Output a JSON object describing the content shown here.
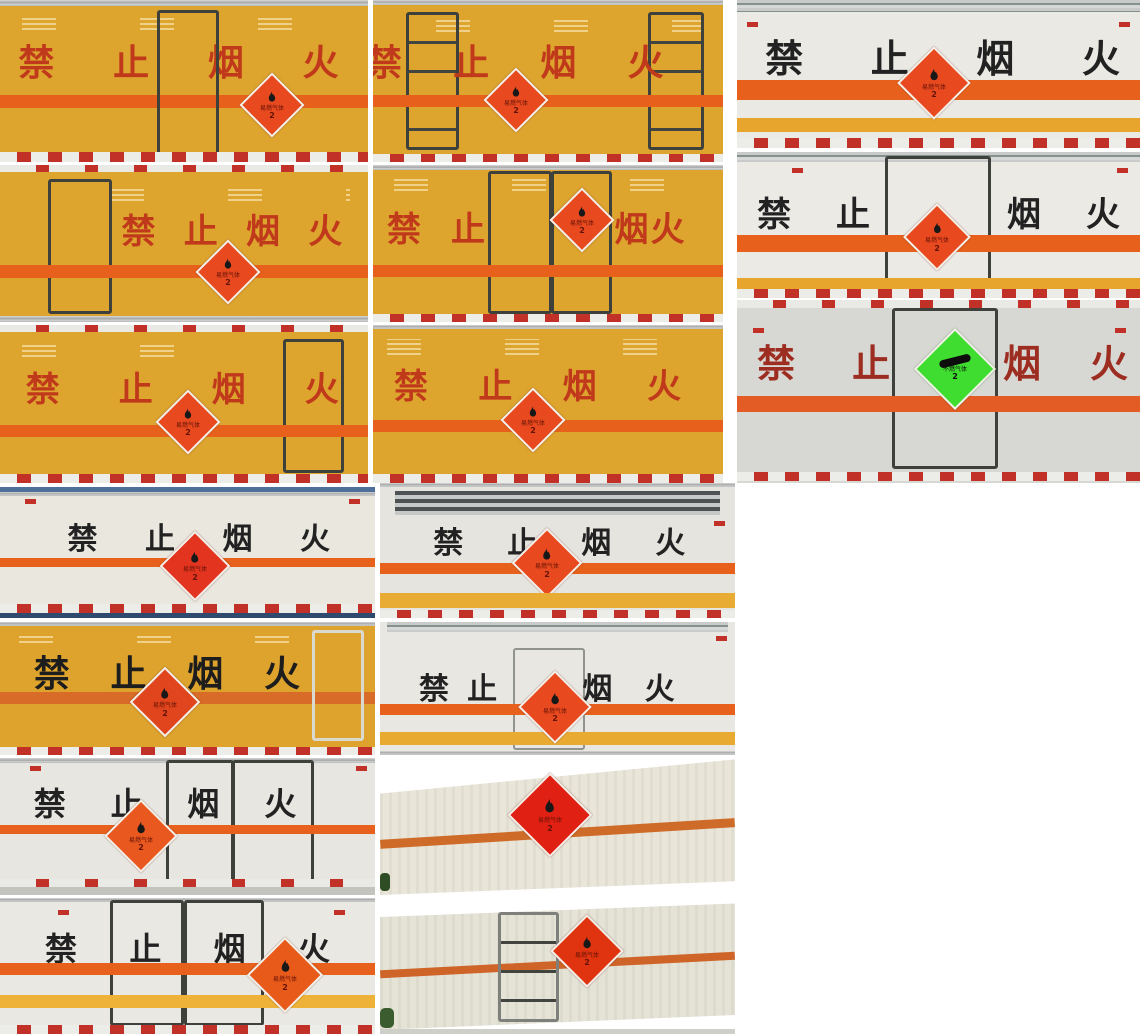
{
  "collage": {
    "warning_text": "禁止烟火",
    "warning_left": "禁止",
    "warning_right": "烟火",
    "placards": {
      "flammable_gas": {
        "label": "易燃气体",
        "class_no": "2"
      },
      "non_flammable_gas": {
        "label": "不燃气体",
        "class_no": "2"
      }
    },
    "colors": {
      "orange_panel": "#dda42e",
      "stripe_orange": "#e8611c",
      "stripe_dark_orange": "#d96b28",
      "stripe_yellow": "#e9a92f",
      "warning_text_red": "#c0391b",
      "warning_text_black": "#222222",
      "warning_text_dark_red": "#9c2d20",
      "placard_red": "#e8491f",
      "placard_green": "#3fdd2f",
      "panel_white": "#eae8e2",
      "panel_gray": "#d7d7d4",
      "reflective_red": "#c23128"
    }
  }
}
